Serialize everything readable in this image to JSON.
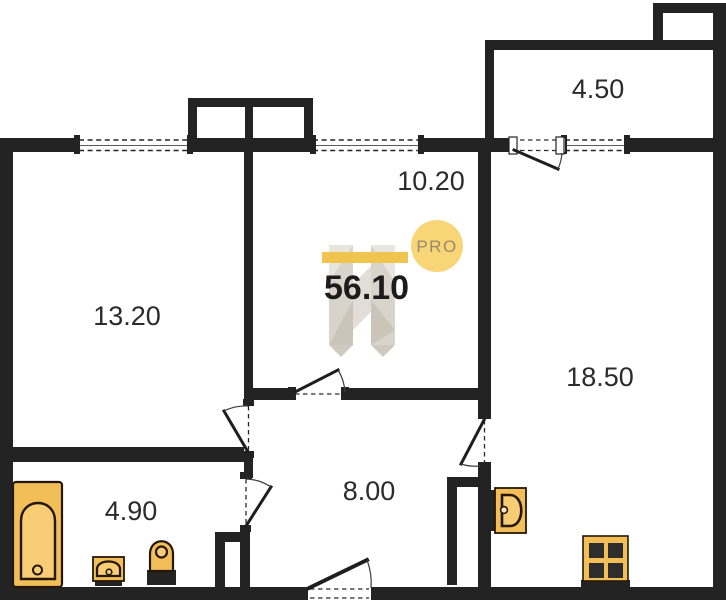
{
  "plan": {
    "type": "apartment-floor-plan",
    "total_area": "56.10",
    "rooms": [
      {
        "name": "loggia",
        "area": "4.50"
      },
      {
        "name": "room-middle",
        "area": "10.20"
      },
      {
        "name": "room-left",
        "area": "13.20"
      },
      {
        "name": "room-right",
        "area": "18.50"
      },
      {
        "name": "bathroom",
        "area": "4.90"
      },
      {
        "name": "hallway",
        "area": "8.00"
      }
    ],
    "watermark": {
      "badge": "PRO"
    },
    "fixtures": [
      "bathtub",
      "wash-sink",
      "toilet",
      "kitchen-sink",
      "stove"
    ],
    "colors": {
      "wall": "#232323",
      "background": "#ffffff",
      "fixture_fill": "#F2BE57",
      "fixture_inner": "#F7CC74",
      "fixture_stroke": "#241708",
      "badge_fill": "#F8D678",
      "badge_text": "#99896C",
      "logo_bar": "#EFC44F",
      "logo_gray": "#D9D4CB",
      "label_color": "#2b2b2b",
      "total_color": "#1c1c1c"
    }
  }
}
